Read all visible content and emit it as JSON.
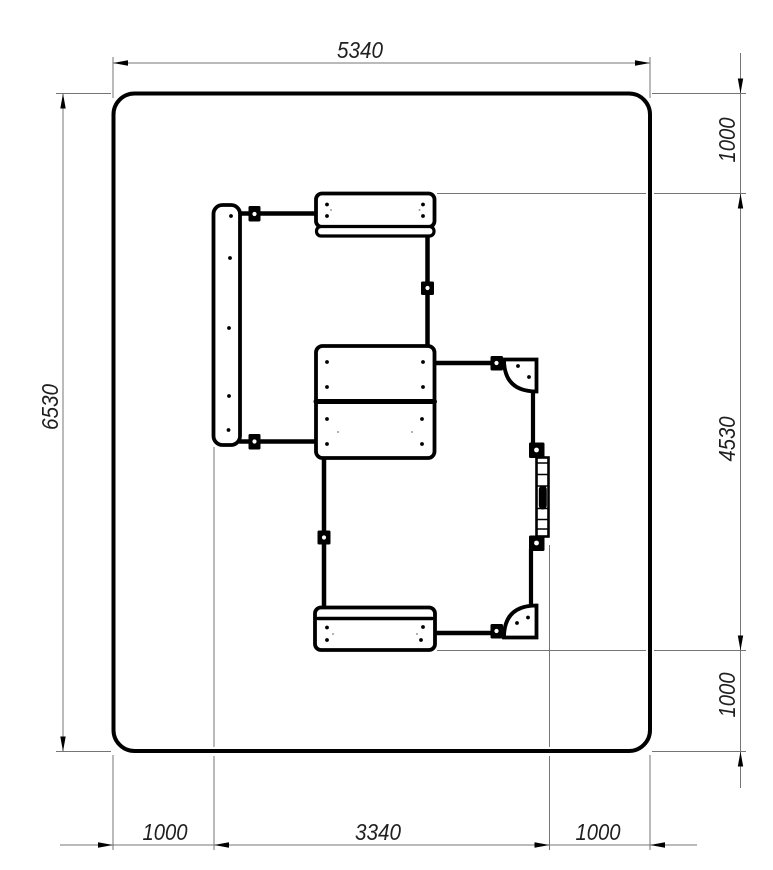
{
  "drawing": {
    "type": "technical-plan-view",
    "colors": {
      "background": "#ffffff",
      "structure_line": "#000000",
      "dimension_line": "#757575",
      "dimension_text": "#1f1f1f"
    },
    "dimensions": {
      "top_width": "5340",
      "left_height": "6530",
      "right_top_offset": "1000",
      "right_equipment_height": "4530",
      "right_bottom_offset": "1000",
      "bottom_left_offset": "1000",
      "bottom_equipment_width": "3340",
      "bottom_right_offset": "1000"
    }
  }
}
